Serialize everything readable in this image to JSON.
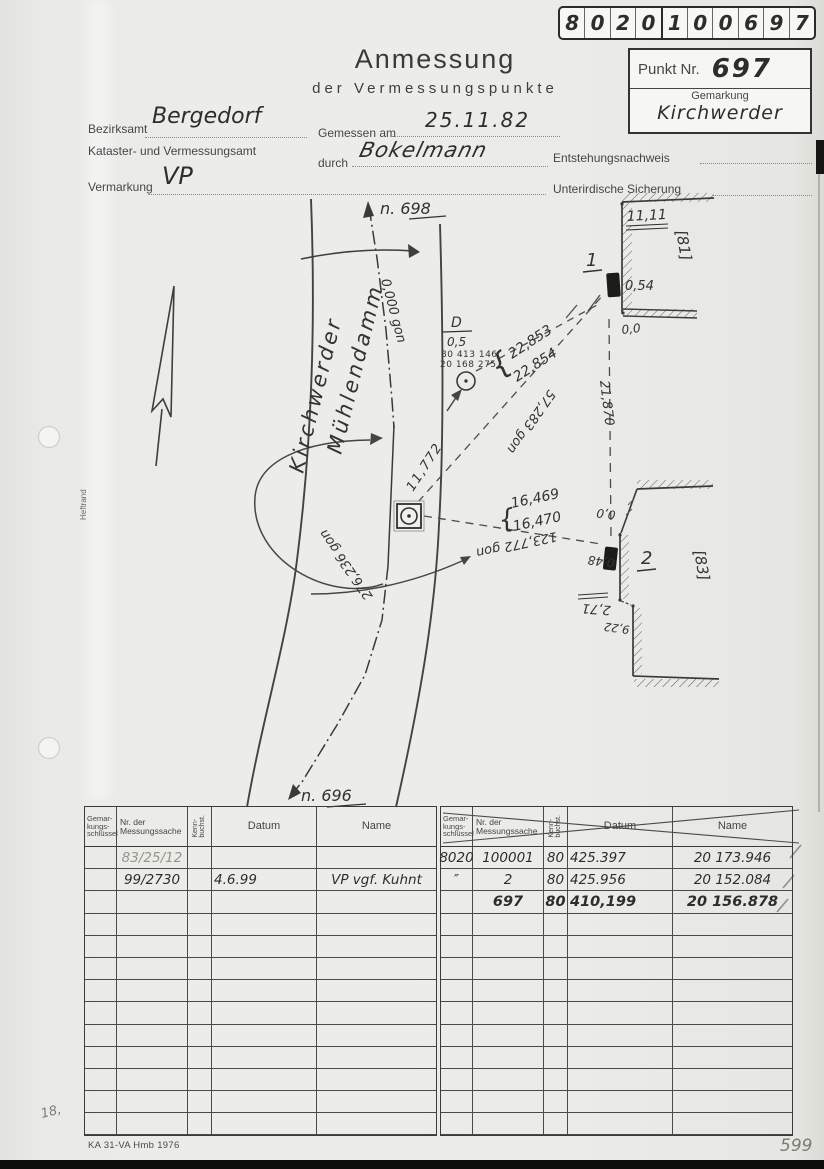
{
  "document": {
    "title": "Anmessung",
    "subtitle": "der Vermessungspunkte",
    "id_strip_digits": [
      "8",
      "0",
      "2",
      "0",
      "1",
      "0",
      "0",
      "6",
      "9",
      "7"
    ],
    "point_box": {
      "punkt_label": "Punkt Nr.",
      "punkt_number": "697",
      "gemarkung_label": "Gemarkung",
      "gemarkung_value": "Kirchwerder"
    },
    "form": {
      "bezirksamt_label": "Bezirksamt",
      "bezirksamt_value": "Bergedorf",
      "amt_line": "Kataster- und Vermessungsamt",
      "gemessen_label": "Gemessen am",
      "gemessen_value": "25.11.82",
      "durch_label": "durch",
      "durch_value": "Bokelmann",
      "entstehung_label": "Entstehungsnachweis",
      "vermarkung_label": "Vermarkung",
      "vermarkung_value": "VP",
      "sicherung_label": "Unterirdische Sicherung"
    },
    "footer": {
      "form_id": "KA 31-VA Hmb 1976",
      "page_number": "599",
      "margin_note": "18,",
      "binding_label": "Heftrand"
    }
  },
  "sketch": {
    "street_line1": "Kirchwerder",
    "street_line2": "Mühlendamm",
    "north_ref": "n. 698",
    "south_ref": "n. 696",
    "bearing_north": "0,000 gon",
    "bearing_p1": "57,283 gon",
    "bearing_p2": "123,772 gon",
    "bearing_back": "276,236 gon",
    "dist_d": "11,772",
    "dist_wall": "21,870",
    "p1_dist_a": "22,853",
    "p1_dist_b": "22,854",
    "p2_dist_a": "16,469",
    "p2_dist_b": "16,470",
    "brace": "{",
    "aux": {
      "label": "D",
      "value": "0,5",
      "coord_x": "80 413 146",
      "coord_y": "20 168 275"
    },
    "p1": {
      "no": "1",
      "len": "11,11",
      "parcel": "[81]",
      "off": "0,54",
      "zero": "0,0"
    },
    "p2": {
      "no": "2",
      "zero": "0,0",
      "off": "0,48",
      "dim": "2,71",
      "len": "9,22",
      "parcel": "[83]"
    }
  },
  "tables": {
    "col1": "Gemar-\nkungs-\nschlüssel",
    "col2": "Nr. der\nMessungssache",
    "col3": "Kenn-\nbuchst.",
    "col4": "Datum",
    "col5": "Name",
    "row_count": 13,
    "left_rows": [
      [
        "",
        "83/25/12",
        "",
        "",
        ""
      ],
      [
        "",
        "99/2730",
        "",
        "4.6.99",
        "VP vgf. Kuhnt"
      ]
    ],
    "right_rows": [
      [
        "8020",
        "100001",
        "80",
        "425.397",
        "20 173.946"
      ],
      [
        "″",
        "2",
        "80",
        "425.956",
        "20 152.084"
      ],
      [
        "",
        "697",
        "80",
        "410,199",
        "20 156.878"
      ]
    ]
  }
}
